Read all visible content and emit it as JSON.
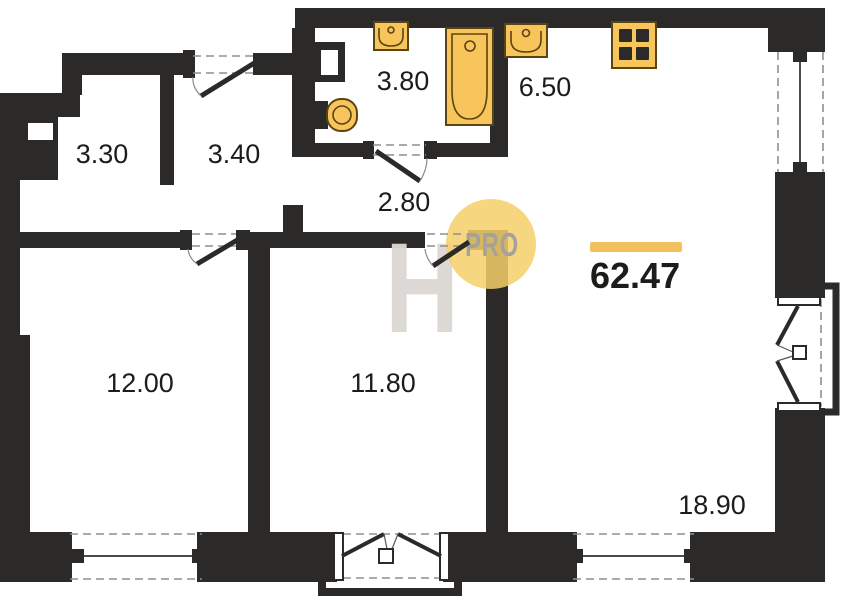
{
  "plan": {
    "total_area": "62.47",
    "rooms": {
      "room_3_30": "3.30",
      "room_3_40": "3.40",
      "room_3_80": "3.80",
      "room_6_50": "6.50",
      "room_2_80": "2.80",
      "room_12_00": "12.00",
      "room_11_80": "11.80",
      "room_18_90": "18.90"
    },
    "watermark": {
      "letter": "H",
      "badge": "PRO"
    },
    "symbols": [
      "bathtub",
      "sink",
      "toilet",
      "cooktop",
      "window",
      "door-swing",
      "french-door",
      "balcony"
    ],
    "colors": {
      "wall": "#2b2a28",
      "fixture": "#f8c45c",
      "fixture-stroke": "#5a4512",
      "accent": "#f2c05c",
      "wm-circle": "#f6cf6a",
      "wm-text": "#a5a29b",
      "wm-letter": "#dcd9d4",
      "dash": "#8f8f8f",
      "label": "#1c1c1a",
      "bg": "#ffffff"
    }
  }
}
